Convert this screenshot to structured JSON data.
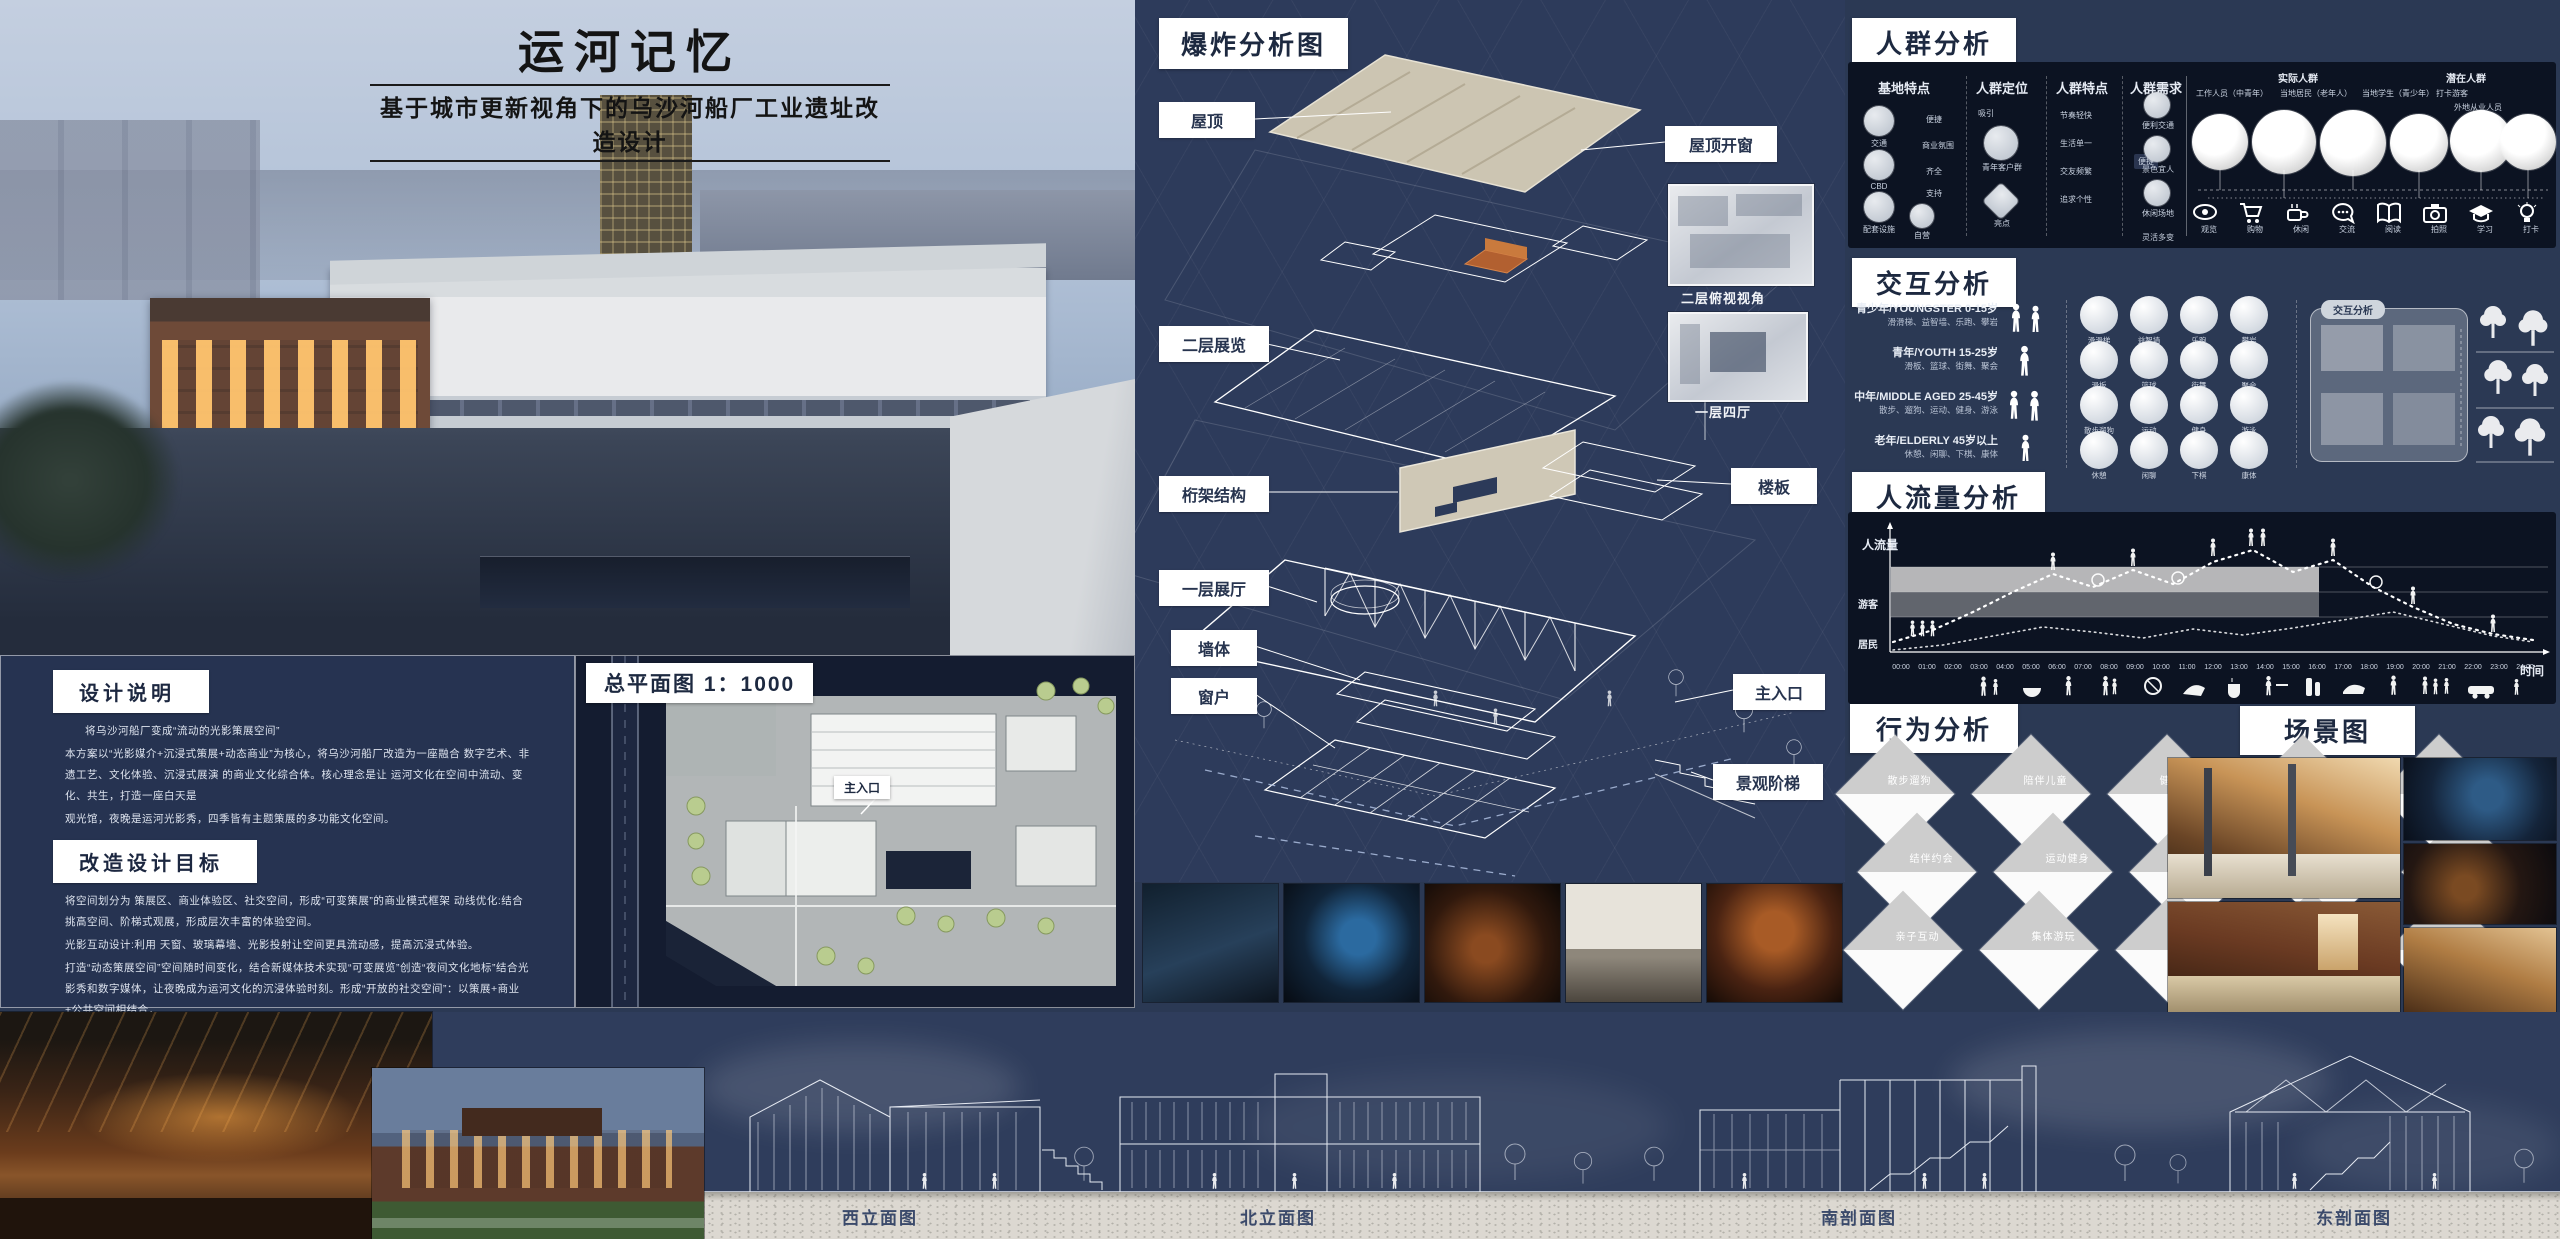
{
  "poster": {
    "title": "运河记忆",
    "subtitle": "基于城市更新视角下的乌沙河船厂工业遗址改造设计"
  },
  "notes": {
    "s1_title": "设计说明",
    "s1_p1": "将乌沙河船厂变成“流动的光影策展空间”",
    "s1_p2": "本方案以“光影媒介+沉浸式策展+动态商业”为核心，将乌沙河船厂改造为一座融合 数字艺术、非遗工艺、文化体验、沉浸式展演 的商业文化综合体。核心理念是让 运河文化在空间中流动、变化、共生，打造一座白天是",
    "s1_p3": "观光馆，夜晚是运河光影秀，四季皆有主题策展的多功能文化空间。",
    "s2_title": "改造设计目标",
    "s2_p1": "将空间划分为 策展区、商业体验区、社交空间，形成“可变策展”的商业模式框架 动线优化:结合 挑高空间、阶梯式观展，形成层次丰富的体验空间。",
    "s2_p2": "光影互动设计:利用 天窗、玻璃幕墙、光影投射让空间更具流动感，提高沉浸式体验。",
    "s2_p3": "打造“动态策展空间”空间随时间变化，结合新媒体技术实现“可变展览”创造“夜间文化地标”结合光影秀和数字媒体，让夜晚成为运河文化的沉浸体验时刻。形成“开放的社交空间”：以策展+商业+公共空间相结合，",
    "s2_p4": "提升场地活力。",
    "s3_title": "动线设计",
    "s3_p1": "按照时间顺序 从古代到现代再到未来，体验淮安运河的历史变迁。展区之间可通过 光影廊道+水波动态投影 连接，强化运河的“流动感”，让参观者在空间游览中感受 时间与文化的流转。",
    "s3_p2": "用时间感知空间：不同时间，不同体验→白天 → 文化展览+商业运营：策展与零售结合，店铺参与展览设计。",
    "s3_p3": "→夜晚 → 沉浸式光影秀+市集体验：灯光变化+水影互动+夜间文化社交场。"
  },
  "siteplan": {
    "title": "总平面图 1：1000",
    "entrance": "主入口"
  },
  "exploded": {
    "title": "爆炸分析图",
    "roof": "屋顶",
    "roof_window": "屋顶开窗",
    "floor2": "二层展览",
    "view2": "二层俯视视角",
    "truss": "桁架结构",
    "hall4": "一层四厅",
    "slab": "楼板",
    "hall1": "一层展厅",
    "wall": "墙体",
    "window": "窗户",
    "entrance": "主入口",
    "steps": "景观阶梯"
  },
  "crowd": {
    "title": "人群分析",
    "col1": "基地特点",
    "col2": "人群定位",
    "col3": "人群特点",
    "col4": "人群需求",
    "base_items": [
      "交通",
      "CBD",
      "配套设施",
      "自营"
    ],
    "base_links": [
      "便捷",
      "商业氛围",
      "齐全",
      "支持"
    ],
    "pos_items": [
      "吸引",
      "青年客户群",
      "亮点"
    ],
    "trait_items": [
      "节奏轻快",
      "生活单一",
      "交友频繁",
      "追求个性"
    ],
    "trait_node": "便捷",
    "need_items": [
      "便利交通",
      "景色宜人",
      "休闲场地",
      "灵活多变"
    ],
    "actual_title": "实际人群",
    "actual_types": [
      "工作人员（中青年）",
      "当地居民（老年人）",
      "当地学生（青少年）",
      "打卡游客"
    ],
    "potential_title": "潜在人群",
    "potential_types": [
      "外地从业人员"
    ],
    "need_icons": [
      "观览",
      "购物",
      "休闲",
      "交流",
      "阅读",
      "拍照",
      "学习",
      "打卡"
    ]
  },
  "interaction": {
    "title": "交互分析",
    "panel_label": "交互分析",
    "groups": [
      {
        "name": "青少年/YOUNGSTER",
        "age": "0-15岁",
        "acts": "滑滑梯、益智墙、乐跑、攀岩",
        "bubbles": [
          "滑滑梯",
          "益智墙",
          "乐跑",
          "攀岩"
        ]
      },
      {
        "name": "青年/YOUTH",
        "age": "15-25岁",
        "acts": "滑板、篮球、街舞、聚会",
        "bubbles": [
          "滑板",
          "篮球",
          "街舞",
          "聚会"
        ]
      },
      {
        "name": "中年/MIDDLE AGED",
        "age": "25-45岁",
        "acts": "散步、遛狗、运动、健身、游泳",
        "bubbles": [
          "散步遛狗",
          "运动",
          "健身",
          "游泳"
        ]
      },
      {
        "name": "老年/ELDERLY",
        "age": "45岁以上",
        "acts": "休憩、闲聊、下棋、康体",
        "bubbles": [
          "休憩",
          "闲聊",
          "下棋",
          "康体"
        ]
      }
    ]
  },
  "flow": {
    "title": "人流量分析",
    "ylabel": "人流量",
    "visitors": "游客",
    "residents": "居民",
    "xlabel": "时间",
    "ticks": [
      "00:00",
      "01:00",
      "02:00",
      "03:00",
      "04:00",
      "05:00",
      "06:00",
      "07:00",
      "08:00",
      "09:00",
      "10:00",
      "11:00",
      "12:00",
      "13:00",
      "14:00",
      "15:00",
      "16:00",
      "17:00",
      "18:00",
      "19:00",
      "20:00",
      "21:00",
      "22:00",
      "23:00",
      "24:00"
    ]
  },
  "behavior": {
    "title": "行为分析",
    "rows": [
      [
        "散步遛狗",
        "陪伴儿童",
        "健身活动",
        "下棋对弈",
        "观景活动"
      ],
      [
        "结伴约会",
        "运动健身",
        "剧本游戏",
        "拍照消遣",
        "欣赏风景"
      ],
      [
        "亲子互动",
        "集体游玩",
        "亲近自然",
        "科普知识",
        "益智游戏"
      ]
    ]
  },
  "scenes": {
    "title": "场景图"
  },
  "elevations": {
    "west": "西立面图",
    "north": "北立面图",
    "south": "南剖面图",
    "east": "东剖面图"
  },
  "colors": {
    "navy": "#2b3954",
    "panel_dark": "#0c1322",
    "beige": "#cdc6b4",
    "orange": "#b26030",
    "tile_gray": "#cfcfcf",
    "ground": "#dcd8d1",
    "tree": "#b9cc8f"
  }
}
